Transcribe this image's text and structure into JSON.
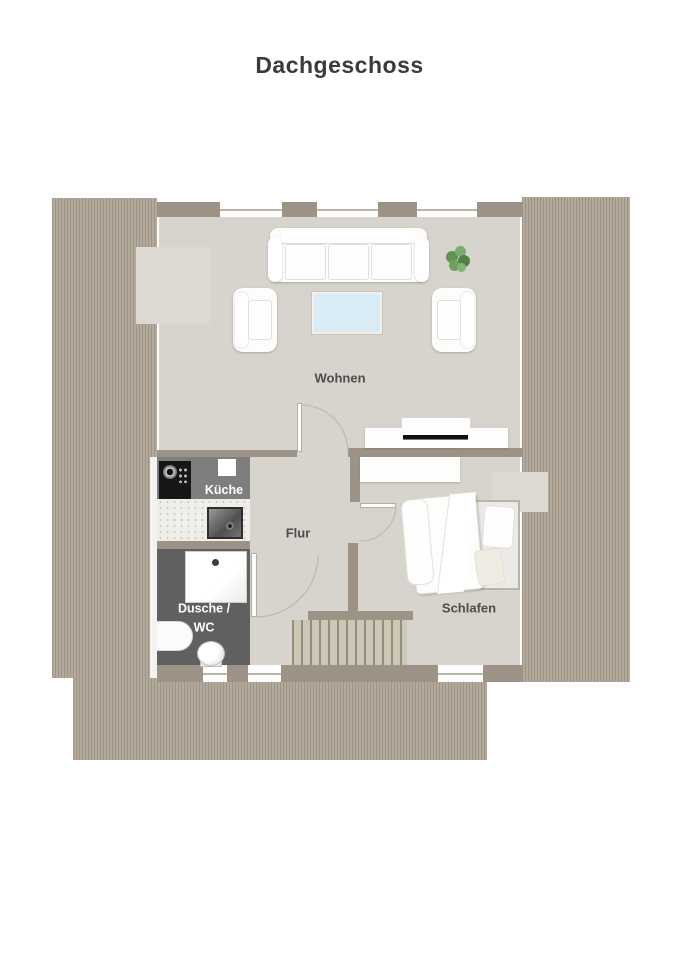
{
  "title": "Dachgeschoss",
  "rooms": {
    "wohnen": {
      "label": "Wohnen"
    },
    "kueche": {
      "label": "Küche"
    },
    "flur": {
      "label": "Flur"
    },
    "dusche_wc": {
      "line1": "Dusche /",
      "line2": "WC"
    },
    "schlafen": {
      "label": "Schlafen"
    }
  },
  "furniture_icons": [
    "sofa",
    "armchair",
    "coffee-table",
    "plant",
    "tv-sideboard",
    "wardrobe",
    "double-bed",
    "cooktop",
    "kitchen-sink",
    "shower",
    "washbasin",
    "toilet",
    "staircase",
    "door-swing"
  ],
  "colors": {
    "page_bg": "#ffffff",
    "roof_hatch_dark": "#9e9486",
    "roof_hatch_light": "#b3aa9c",
    "wall": "#9c9285",
    "floor": "#d7d3cd",
    "dormer_floor": "#dcd9d3",
    "kitchen_floor": "#7e7e7e",
    "bath_floor": "#606060",
    "counter": "#efeee9",
    "cooktop": "#161616",
    "coffee_table_glass": "#d9ebf4",
    "stair_tread": "#ccc8b5",
    "stair_gap": "#948c80",
    "label_dark": "#4d4d4d",
    "label_light": "#ffffff",
    "plant_green": "#5f9454"
  }
}
